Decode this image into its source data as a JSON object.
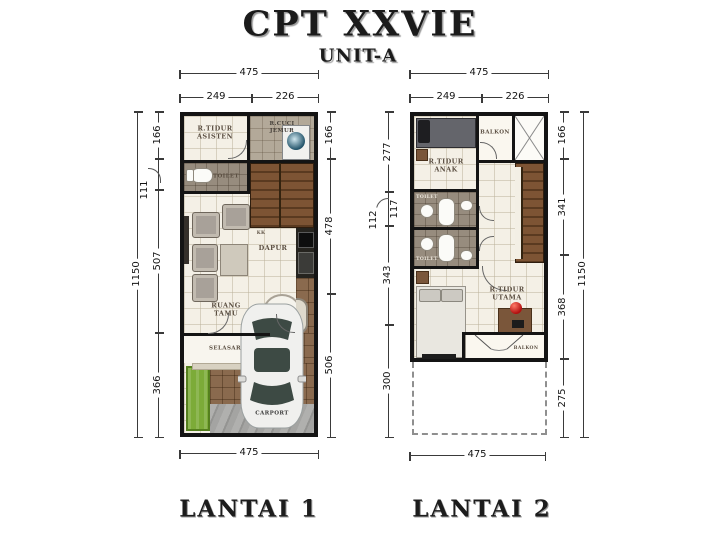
{
  "header": {
    "title": "CPT XXVIE",
    "subtitle": "UNIT-A"
  },
  "floor1": {
    "label": "LANTAI 1",
    "dims": {
      "top_total": "475",
      "top_left": "249",
      "top_right": "226",
      "left_total": "1150",
      "left_a": "166",
      "left_b": "111",
      "left_c": "507",
      "left_d": "366",
      "right_a": "166",
      "right_b": "478",
      "right_c": "506",
      "bottom_total": "475"
    },
    "rooms": {
      "assistant_bedroom": "R.TIDUR\nASISTEN",
      "laundry": "R.CUCI\nJEMUR",
      "toilet": "TOILET",
      "kitchen_note": "KK",
      "kitchen": "DAPUR",
      "living": "RUANG\nTAMU",
      "corridor": "SELASAR",
      "carport": "CARPORT"
    }
  },
  "floor2": {
    "label": "LANTAI 2",
    "dims": {
      "top_total": "475",
      "top_left": "249",
      "top_right": "226",
      "left_a": "277",
      "left_b": "117",
      "left_b_callout": "112",
      "left_c": "343",
      "left_d": "300",
      "right_a": "166",
      "right_b": "341",
      "right_c": "368",
      "right_d": "275",
      "right_total": "1150",
      "bottom_total": "475"
    },
    "rooms": {
      "kids_bedroom": "R.TIDUR\nANAK",
      "balcony_top": "BALKON",
      "toilet_upper": "TOILET",
      "toilet_lower": "TOILET",
      "master_bedroom": "R.TIDUR\nUTAMA",
      "balcony_bottom": "BALKON"
    }
  }
}
